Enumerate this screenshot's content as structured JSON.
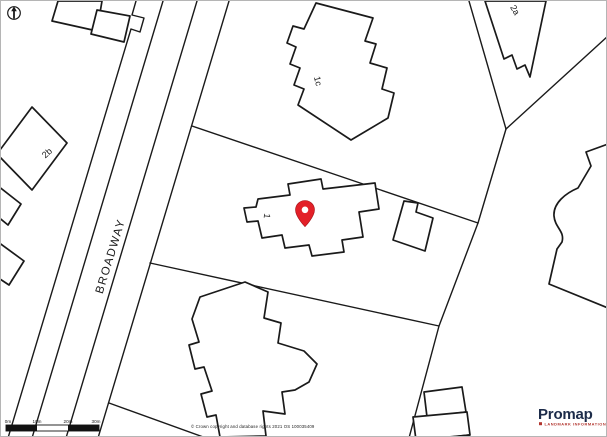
{
  "map": {
    "road_label": "BROADWAY",
    "plot_labels": {
      "plot_1": "1",
      "plot_1c": "1c",
      "plot_2b": "2b",
      "plot_2a": "2a"
    }
  },
  "scale_bar": {
    "labels": [
      "0m",
      "10m",
      "20m",
      "30m"
    ]
  },
  "attribution": {
    "copyright": "© Crown copyright and database rights 2021 OS 100035409"
  },
  "branding": {
    "logo_text": "Promap",
    "tagline": "LANDMARK INFORMATION"
  },
  "colors": {
    "line": "#1a1a1a",
    "pin_red": "#e32028",
    "pin_stroke": "#a31218",
    "brand_navy": "#1c2b49",
    "brand_red": "#b2352e"
  }
}
